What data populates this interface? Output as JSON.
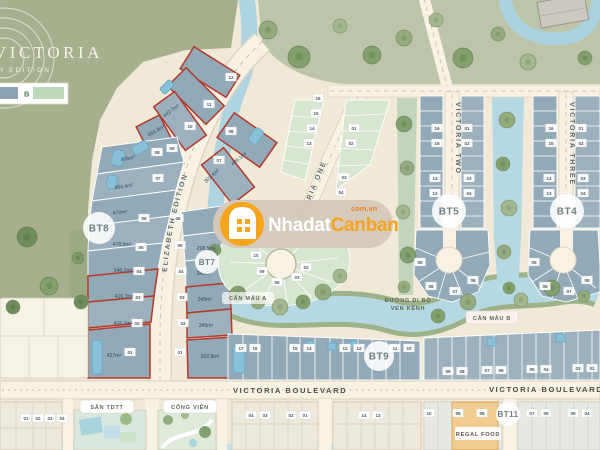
{
  "logo": {
    "title": "VICTORIA",
    "subtitle": "H EDITION"
  },
  "legend": {
    "b": "B"
  },
  "colors": {
    "lot_type_a": "#8aa2b4",
    "lot_type_b": "#bcd9ba",
    "highlight_red": "#b43a2c",
    "brand_orange": "#f6a41c",
    "water": "#aed3e1",
    "regal_orange": "#f0cb92"
  },
  "watermark": {
    "brand_light": "Nhadat",
    "brand_orange": "Canban",
    "domain": "com.vn"
  },
  "roads": {
    "elizabeth": "ELIZABETH EDITION",
    "victoria_one": "VICTORIA ONE",
    "victoria_two": "VICTORIA TWO",
    "victoria_three": "VICTORIA THREE",
    "boulevard": "VICTORIA BOULEVARD"
  },
  "badges": {
    "bt8": "BT8",
    "bt7": "BT7",
    "bt5": "BT5",
    "bt4": "BT4",
    "bt9": "BT9",
    "bt11": "BT11"
  },
  "labels": {
    "can_mau_a": "CĂN MẪU A",
    "can_mau_b": "CĂN MẪU B",
    "walkway_line1": "ĐƯỜNG ĐI BỘ",
    "walkway_line2": "VEN KÊNH",
    "san_tdtt": "SÂN TDTT",
    "cong_vien": "CÔNG VIÊN",
    "regal_food": "REGAL FOOD"
  },
  "bt8": {
    "fan": [
      {
        "num": "12",
        "area": ""
      },
      {
        "num": "11",
        "area": "442.7m²"
      },
      {
        "num": "10",
        "area": "451.4m²"
      },
      {
        "num": "09",
        "area": ""
      }
    ],
    "rows": [
      {
        "num": "08",
        "area": "406m²"
      },
      {
        "num": "07",
        "area": "484.4m²"
      },
      {
        "num": "06",
        "area": "472m²"
      },
      {
        "num": "05",
        "area": "478.5m²"
      },
      {
        "num": "04",
        "area": "346.1m²"
      },
      {
        "num": "03",
        "area": "416.7m²"
      },
      {
        "num": "02",
        "area": "416.7m²"
      },
      {
        "num": "01",
        "area": "427m²"
      }
    ]
  },
  "bt7": {
    "arc": [
      {
        "num": "08",
        "area": "406.1m²"
      },
      {
        "num": "07",
        "area": "302.4m²"
      }
    ],
    "rows": [
      {
        "num": "06",
        "area": ""
      },
      {
        "num": "05",
        "area": "298.5m²"
      },
      {
        "num": "04",
        "area": "345m²"
      },
      {
        "num": "03",
        "area": "345m²"
      },
      {
        "num": "02",
        "area": "345m²"
      },
      {
        "num": "01",
        "area": "302.8m²"
      }
    ]
  },
  "chips": {
    "vone_left": [
      "16",
      "15",
      "14",
      "13"
    ],
    "vone_right": [
      "01",
      "02",
      "03",
      "04"
    ],
    "lagoon": [
      "10",
      "09",
      "08",
      "03",
      "02"
    ],
    "bt5_left": [
      "16",
      "15",
      "14",
      "13"
    ],
    "bt5_right": [
      "01",
      "02",
      "03",
      "04"
    ],
    "bt5_bulb": [
      "05",
      "06",
      "07",
      "08"
    ],
    "bt4_left": [
      "16",
      "15",
      "14",
      "13"
    ],
    "bt4_right": [
      "01",
      "02",
      "03",
      "04"
    ],
    "bt4_bulb": [
      "05",
      "06",
      "07",
      "08"
    ],
    "bt9_left": [
      "17",
      "16",
      "15",
      "14",
      "13",
      "12",
      "11",
      "10"
    ],
    "bt9_right": [
      "09",
      "08",
      "07",
      "06",
      "05",
      "04",
      "03",
      "02"
    ],
    "bottom_far_left": [
      "01",
      "02",
      "03",
      "04"
    ],
    "bottom_mid_a": [
      "04",
      "03",
      "02",
      "01"
    ],
    "bottom_mid_b": [
      "14",
      "13"
    ],
    "bottom_right_a": [
      "10",
      "09",
      "08"
    ],
    "bottom_right_b": [
      "07",
      "06",
      "05",
      "04"
    ]
  }
}
